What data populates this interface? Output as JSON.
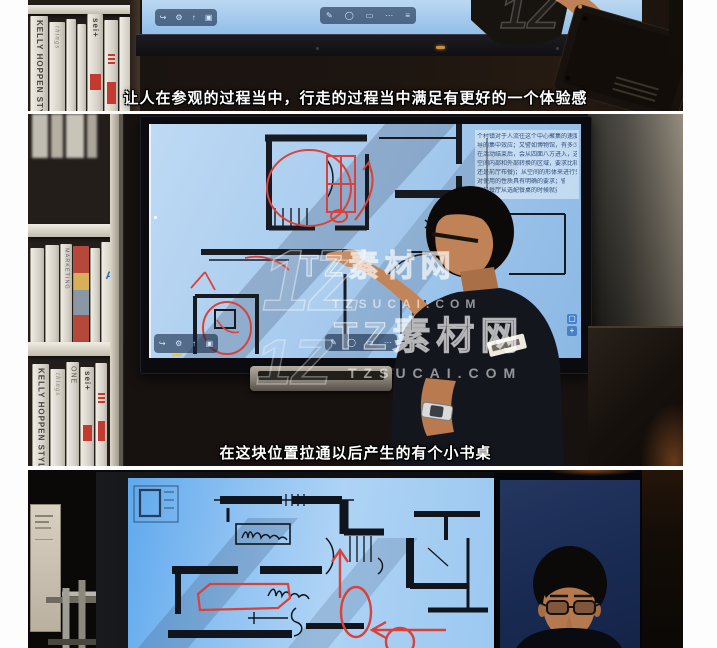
{
  "subtitles": {
    "top": "让人在参观的过程当中，行走的过程当中满足有更好的一个体验感",
    "middle": "在这块位置拉通以后产生的有个小书桌"
  },
  "watermark": {
    "brand": "TZ素材网",
    "domain": "TZSUCAI.COM",
    "logo": "1Z"
  },
  "bookshelf": {
    "spine1": "KELLY HOPPEN STYLE",
    "spine2": "sei+",
    "spine3": "MARKETING",
    "spine4": "ONE",
    "spine5": "things",
    "spine6": "A"
  },
  "screen_document": {
    "lines": [
      "个村镇对于人流往这个中心聚集的速度",
      "导的集中效应；又譬如博物馆，有多少时",
      "在活动结束后，会从四面八方进入，这就",
      "空间内部和外部转换的区域，要求比较宽",
      "还是前厅布餐)；从空间的形体来进行分",
      "对使用的性质具有明确的要求；譬如",
      "者是餐厅从选配餐桌的时候就要根据"
    ]
  },
  "display_toolbar": {
    "left_icons": [
      {
        "name": "exit",
        "glyph": "↪"
      },
      {
        "name": "settings",
        "glyph": "⚙"
      },
      {
        "name": "save",
        "glyph": "↑"
      },
      {
        "name": "capture",
        "glyph": "▣"
      }
    ],
    "right_icons": [
      {
        "name": "pen",
        "glyph": "✎"
      },
      {
        "name": "lasso",
        "glyph": "◯"
      },
      {
        "name": "eraser",
        "glyph": "▭"
      },
      {
        "name": "shapes",
        "glyph": "⋯"
      },
      {
        "name": "more",
        "glyph": "≡"
      }
    ],
    "side_buttons": [
      "▢",
      "+"
    ]
  },
  "colors": {
    "screen_blue": "#a8cbee",
    "screen_blue_bright": "#5fa9ee",
    "annotation_red": "#d8423a",
    "face_monitor_navy": "#1b2c55",
    "subtitle_white": "#ffffff",
    "watermark_white": "#ffffff",
    "toolbar_dark_blue": "#10223e",
    "indicator_amber": "#cf8f3a"
  }
}
